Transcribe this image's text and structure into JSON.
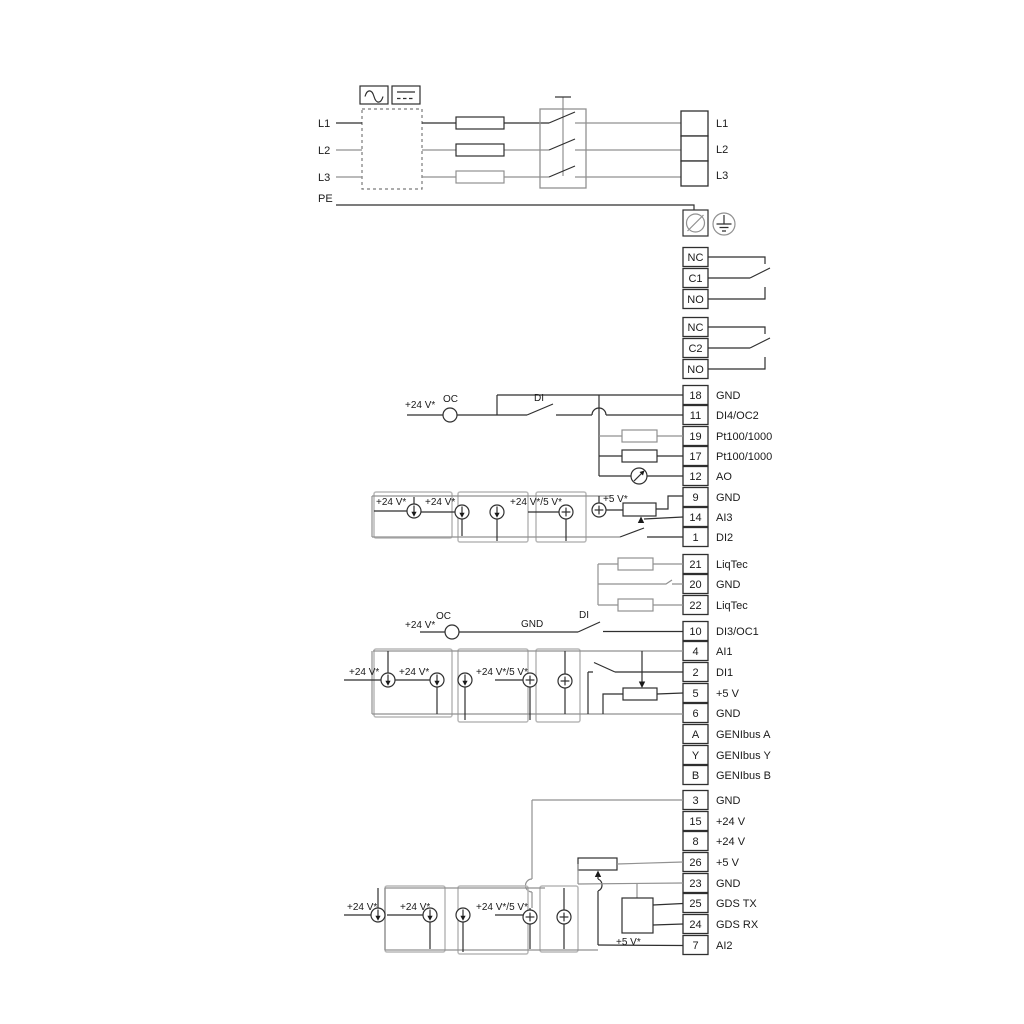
{
  "power": {
    "in": [
      "L1",
      "L2",
      "L3",
      "PE"
    ],
    "out": [
      "L1",
      "L2",
      "L3"
    ]
  },
  "relay1": {
    "rows": [
      "NC",
      "C1",
      "NO"
    ]
  },
  "relay2": {
    "rows": [
      "NC",
      "C2",
      "NO"
    ]
  },
  "strip1": {
    "rows": [
      {
        "num": "18",
        "label": "GND"
      },
      {
        "num": "11",
        "label": "DI4/OC2"
      },
      {
        "num": "19",
        "label": "Pt100/1000"
      },
      {
        "num": "17",
        "label": "Pt100/1000"
      },
      {
        "num": "12",
        "label": "AO"
      },
      {
        "num": "9",
        "label": "GND"
      },
      {
        "num": "14",
        "label": "AI3"
      },
      {
        "num": "1",
        "label": "DI2"
      }
    ]
  },
  "liqtec": {
    "rows": [
      {
        "num": "21",
        "label": "LiqTec"
      },
      {
        "num": "20",
        "label": "GND"
      },
      {
        "num": "22",
        "label": "LiqTec"
      }
    ]
  },
  "strip2": {
    "rows": [
      {
        "num": "10",
        "label": "DI3/OC1"
      },
      {
        "num": "4",
        "label": "AI1"
      },
      {
        "num": "2",
        "label": "DI1"
      },
      {
        "num": "5",
        "label": "+5 V"
      },
      {
        "num": "6",
        "label": "GND"
      },
      {
        "num": "A",
        "label": "GENIbus A"
      },
      {
        "num": "Y",
        "label": "GENIbus Y"
      },
      {
        "num": "B",
        "label": "GENIbus B"
      }
    ]
  },
  "strip3": {
    "rows": [
      {
        "num": "3",
        "label": "GND"
      },
      {
        "num": "15",
        "label": "+24 V"
      },
      {
        "num": "8",
        "label": "+24 V"
      },
      {
        "num": "26",
        "label": "+5 V"
      },
      {
        "num": "23",
        "label": "GND"
      },
      {
        "num": "25",
        "label": "GDS TX"
      },
      {
        "num": "24",
        "label": "GDS RX"
      },
      {
        "num": "7",
        "label": "AI2"
      }
    ]
  },
  "ann": {
    "oc": "OC",
    "di": "DI",
    "gnd": "GND",
    "v24": "+24 V*",
    "v24v5": "+24 V*/5 V*",
    "v5": "+5 V*"
  },
  "colors": {
    "line": "#2f2f2f",
    "gray": "#919191",
    "option_box": "#b8b8b8"
  }
}
